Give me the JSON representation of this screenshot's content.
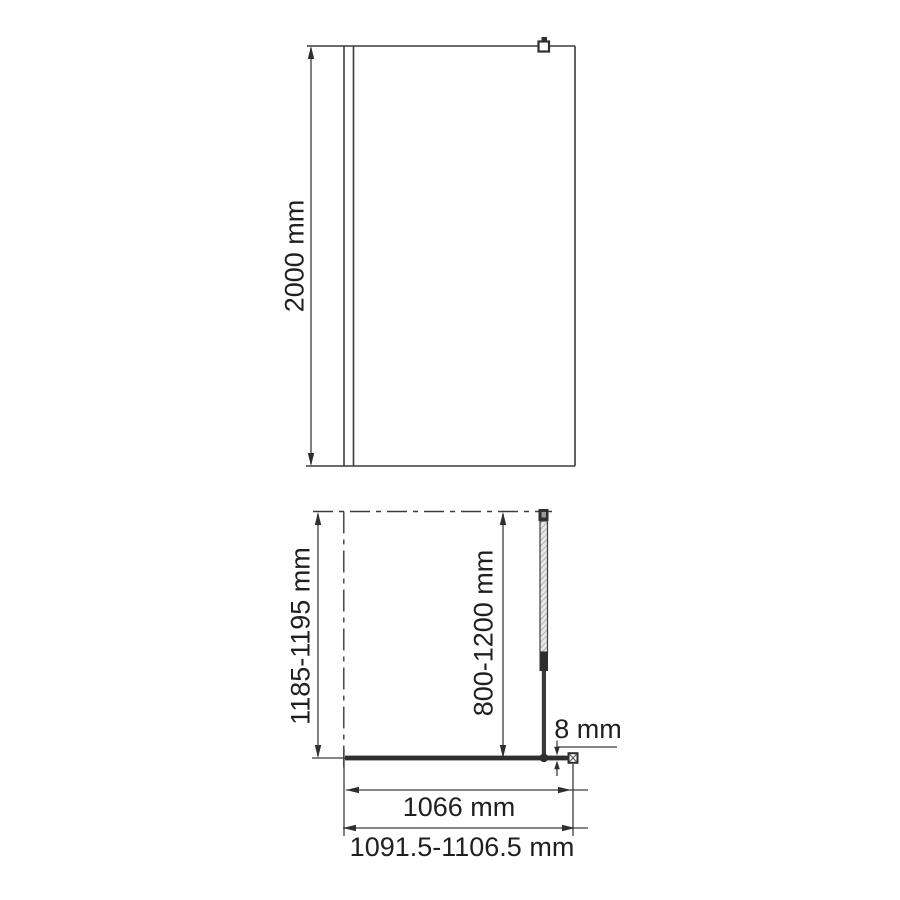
{
  "diagram": {
    "kind": "shower-screen-dimension-drawing",
    "front_view": {
      "height_dimension": "2000 mm"
    },
    "top_view": {
      "depth_dimension": "1185-1195 mm",
      "support_bar_dimension": "800-1200 mm",
      "glass_thickness_dimension": "8 mm",
      "glass_width_dimension": "1066 mm",
      "overall_width_dimension": "1091.5-1106.5 mm"
    },
    "colors": {
      "line": "#3c3c3c",
      "dark": "#2f2f2f",
      "text": "#1f1f1f",
      "background": "#ffffff"
    }
  }
}
